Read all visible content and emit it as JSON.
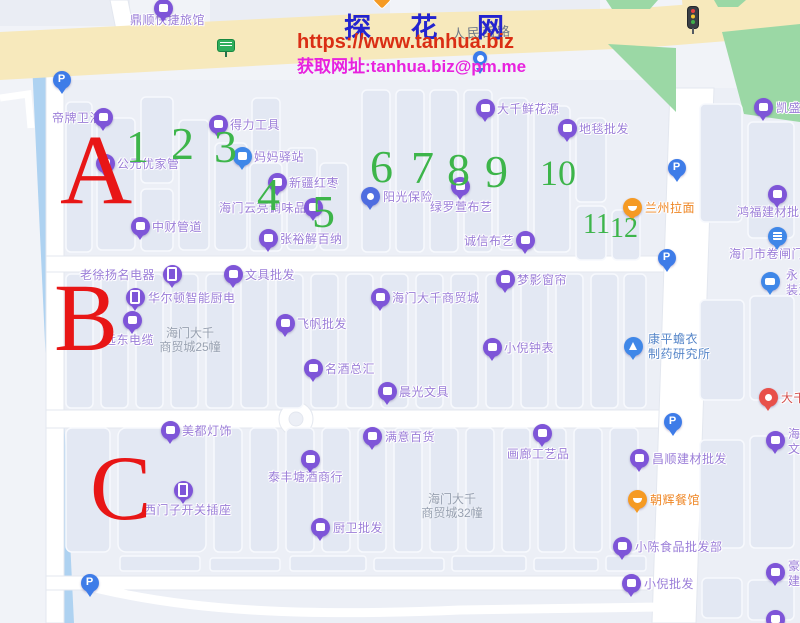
{
  "watermark": {
    "title": "探 花 网",
    "url": "https://www.tanhua.biz",
    "contact": "获取网址:tanhua.biz@pm.me"
  },
  "map": {
    "road_label": "人民西路",
    "markers": {
      "letters": [
        {
          "t": "A",
          "x": 60,
          "y": 120,
          "s": 100
        },
        {
          "t": "B",
          "x": 54,
          "y": 270,
          "s": 96
        },
        {
          "t": "C",
          "x": 90,
          "y": 442,
          "s": 92
        }
      ],
      "numbers": [
        {
          "t": "1",
          "x": 126,
          "y": 124,
          "s": 46
        },
        {
          "t": "2",
          "x": 171,
          "y": 121,
          "s": 46
        },
        {
          "t": "3",
          "x": 214,
          "y": 124,
          "s": 46
        },
        {
          "t": "4",
          "x": 257,
          "y": 172,
          "s": 46
        },
        {
          "t": "5",
          "x": 312,
          "y": 189,
          "s": 46
        },
        {
          "t": "6",
          "x": 370,
          "y": 144,
          "s": 46
        },
        {
          "t": "7",
          "x": 411,
          "y": 145,
          "s": 46
        },
        {
          "t": "8",
          "x": 447,
          "y": 147,
          "s": 46
        },
        {
          "t": "9",
          "x": 485,
          "y": 149,
          "s": 46
        },
        {
          "t": "10",
          "x": 540,
          "y": 155,
          "s": 36
        },
        {
          "t": "11",
          "x": 583,
          "y": 211,
          "s": 28
        },
        {
          "t": "12",
          "x": 610,
          "y": 215,
          "s": 28
        }
      ]
    },
    "pois": [
      {
        "name": "鼎顺快捷旅馆",
        "icon": "shop",
        "x": 163,
        "y": 8,
        "label": {
          "lines": [
            "鼎顺快捷旅馆"
          ],
          "lx": 130,
          "ly": 13
        }
      },
      {
        "name": "顶部橙色兴趣点",
        "icon": "diamond",
        "x": 385,
        "y": 3
      },
      {
        "name": "公交站牌",
        "icon": "busstop",
        "x": 227,
        "y": 49
      },
      {
        "name": "红绿灯",
        "icon": "light",
        "x": 697,
        "y": 16
      },
      {
        "name": "蓝色图钉",
        "icon": "bluepin",
        "x": 480,
        "y": 58
      },
      {
        "name": "凯盛",
        "icon": "shop",
        "x": 763,
        "y": 107,
        "label": {
          "lines": [
            "凯盛"
          ],
          "lx": 776,
          "ly": 101
        }
      },
      {
        "name": "帝牌卫浴",
        "icon": "shop",
        "x": 103,
        "y": 117,
        "label": {
          "lines": [
            "帝牌卫浴"
          ],
          "lx": 52,
          "ly": 111
        }
      },
      {
        "name": "得力工具",
        "icon": "shop",
        "x": 218,
        "y": 124,
        "label": {
          "lines": [
            "得力工具"
          ],
          "lx": 230,
          "ly": 118
        }
      },
      {
        "name": "妈妈驿站",
        "icon": "blueshop",
        "x": 242,
        "y": 156,
        "label": {
          "lines": [
            "妈妈驿站"
          ],
          "lx": 254,
          "ly": 150
        }
      },
      {
        "name": "公元优家管",
        "icon": "shop",
        "x": 105,
        "y": 163,
        "label": {
          "lines": [
            "公元优家管"
          ],
          "lx": 117,
          "ly": 157
        }
      },
      {
        "name": "新疆红枣",
        "icon": "shop",
        "x": 277,
        "y": 182,
        "label": {
          "lines": [
            "新疆红枣"
          ],
          "lx": 289,
          "ly": 176
        }
      },
      {
        "name": "海门云亮调味品",
        "icon": "shop",
        "x": 313,
        "y": 207,
        "label": {
          "lines": [
            "海门云亮调味品"
          ],
          "lx": 219,
          "ly": 201
        }
      },
      {
        "name": "中财管道",
        "icon": "shop",
        "x": 140,
        "y": 226,
        "label": {
          "lines": [
            "中财管道"
          ],
          "lx": 152,
          "ly": 220
        }
      },
      {
        "name": "张裕解百纳",
        "icon": "shop",
        "x": 268,
        "y": 238,
        "label": {
          "lines": [
            "张裕解百纳"
          ],
          "lx": 280,
          "ly": 232
        }
      },
      {
        "name": "阳光保险",
        "icon": "sun",
        "x": 370,
        "y": 196,
        "label": {
          "lines": [
            "阳光保险"
          ],
          "lx": 383,
          "ly": 190
        }
      },
      {
        "name": "绿罗萱布艺",
        "icon": "shop",
        "x": 460,
        "y": 186,
        "label": {
          "lines": [
            "绿罗萱布艺"
          ],
          "lx": 430,
          "ly": 200
        }
      },
      {
        "name": "大千鲜花源",
        "icon": "shop",
        "x": 485,
        "y": 108,
        "label": {
          "lines": [
            "大千鲜花源"
          ],
          "lx": 497,
          "ly": 102
        }
      },
      {
        "name": "地毯批发",
        "icon": "shop",
        "x": 567,
        "y": 128,
        "label": {
          "lines": [
            "地毯批发"
          ],
          "lx": 579,
          "ly": 122
        }
      },
      {
        "name": "诚信布艺",
        "icon": "shop",
        "x": 525,
        "y": 240,
        "label": {
          "lines": [
            "诚信布艺"
          ],
          "lx": 464,
          "ly": 234
        }
      },
      {
        "name": "兰州拉面",
        "icon": "food",
        "x": 632,
        "y": 207,
        "label": {
          "lines": [
            "兰州拉面"
          ],
          "lx": 645,
          "ly": 201,
          "cls": "orange"
        }
      },
      {
        "name": "鸿福建材批发",
        "icon": "shop",
        "x": 777,
        "y": 194,
        "label": {
          "lines": [
            "鸿福建材批发"
          ],
          "lx": 737,
          "ly": 205
        }
      },
      {
        "name": "海门市卷闸门",
        "icon": "door",
        "x": 777,
        "y": 236,
        "label": {
          "lines": [
            "海门市卷闸门"
          ],
          "lx": 729,
          "ly": 247
        }
      },
      {
        "name": "永昌装潢",
        "icon": "bus",
        "x": 770,
        "y": 281,
        "label": {
          "lines": [
            "永昌",
            "装潢"
          ],
          "lx": 786,
          "ly": 268
        }
      },
      {
        "name": "老徐扬名电器",
        "icon": "phone",
        "x": 172,
        "y": 274,
        "label": {
          "lines": [
            "老徐扬名电器"
          ],
          "lx": 80,
          "ly": 268
        }
      },
      {
        "name": "文具批发",
        "icon": "shop",
        "x": 233,
        "y": 274,
        "label": {
          "lines": [
            "文具批发"
          ],
          "lx": 245,
          "ly": 268
        }
      },
      {
        "name": "华尔顿智能厨电",
        "icon": "phone",
        "x": 135,
        "y": 297,
        "label": {
          "lines": [
            "华尔顿智能厨电"
          ],
          "lx": 148,
          "ly": 291
        }
      },
      {
        "name": "远东电缆",
        "icon": "shop",
        "x": 132,
        "y": 320,
        "label": {
          "lines": [
            "远东电缆"
          ],
          "lx": 104,
          "ly": 333
        }
      },
      {
        "name": "海门大千商贸城",
        "icon": "shop",
        "x": 380,
        "y": 297,
        "label": {
          "lines": [
            "海门大千商贸城"
          ],
          "lx": 392,
          "ly": 291
        }
      },
      {
        "name": "梦影窗帘",
        "icon": "shop",
        "x": 505,
        "y": 279,
        "label": {
          "lines": [
            "梦影窗帘"
          ],
          "lx": 517,
          "ly": 273
        }
      },
      {
        "name": "飞帆批发",
        "icon": "shop",
        "x": 285,
        "y": 323,
        "label": {
          "lines": [
            "飞帆批发"
          ],
          "lx": 297,
          "ly": 317
        }
      },
      {
        "name": "小倪钟表",
        "icon": "shop",
        "x": 492,
        "y": 347,
        "label": {
          "lines": [
            "小倪钟表"
          ],
          "lx": 504,
          "ly": 341
        }
      },
      {
        "name": "名酒总汇",
        "icon": "shop",
        "x": 313,
        "y": 368,
        "label": {
          "lines": [
            "名酒总汇"
          ],
          "lx": 325,
          "ly": 362
        }
      },
      {
        "name": "晨光文具",
        "icon": "shop",
        "x": 387,
        "y": 391,
        "label": {
          "lines": [
            "晨光文具"
          ],
          "lx": 399,
          "ly": 385
        }
      },
      {
        "name": "康平蟾衣制药研究所",
        "icon": "flask",
        "x": 633,
        "y": 346,
        "label": {
          "lines": [
            "康平蟾衣",
            "制药研究所"
          ],
          "lx": 648,
          "ly": 332,
          "cls": "blue"
        }
      },
      {
        "name": "大千",
        "icon": "red",
        "x": 768,
        "y": 397,
        "label": {
          "lines": [
            "大千"
          ],
          "lx": 781,
          "ly": 391,
          "cls": "red"
        }
      },
      {
        "name": "海门文",
        "icon": "shop",
        "x": 775,
        "y": 440,
        "label": {
          "lines": [
            "海",
            "文"
          ],
          "lx": 788,
          "ly": 427
        }
      },
      {
        "name": "美都灯饰",
        "icon": "shop",
        "x": 170,
        "y": 430,
        "label": {
          "lines": [
            "美都灯饰"
          ],
          "lx": 182,
          "ly": 424
        }
      },
      {
        "name": "西门子开关插座",
        "icon": "phone",
        "x": 183,
        "y": 490,
        "label": {
          "lines": [
            "西门子开关插座"
          ],
          "lx": 144,
          "ly": 503
        }
      },
      {
        "name": "泰丰塘酒商行",
        "icon": "shop",
        "x": 310,
        "y": 459,
        "label": {
          "lines": [
            "泰丰塘酒商行"
          ],
          "lx": 268,
          "ly": 470
        }
      },
      {
        "name": "满意百货",
        "icon": "shop",
        "x": 372,
        "y": 436,
        "label": {
          "lines": [
            "满意百货"
          ],
          "lx": 385,
          "ly": 430
        }
      },
      {
        "name": "厨卫批发",
        "icon": "shop",
        "x": 320,
        "y": 527,
        "label": {
          "lines": [
            "厨卫批发"
          ],
          "lx": 333,
          "ly": 521
        }
      },
      {
        "name": "画廊工艺品",
        "icon": "shop",
        "x": 542,
        "y": 433,
        "label": {
          "lines": [
            "画廊工艺品"
          ],
          "lx": 507,
          "ly": 447
        }
      },
      {
        "name": "昌顺建材批发",
        "icon": "shop",
        "x": 639,
        "y": 458,
        "label": {
          "lines": [
            "昌顺建材批发"
          ],
          "lx": 652,
          "ly": 452
        }
      },
      {
        "name": "朝辉餐馆",
        "icon": "food",
        "x": 637,
        "y": 499,
        "label": {
          "lines": [
            "朝辉餐馆"
          ],
          "lx": 650,
          "ly": 493,
          "cls": "orange"
        }
      },
      {
        "name": "小陈食品批发部",
        "icon": "shop",
        "x": 622,
        "y": 546,
        "label": {
          "lines": [
            "小陈食品批发部"
          ],
          "lx": 635,
          "ly": 540
        }
      },
      {
        "name": "小倪批发",
        "icon": "shop",
        "x": 631,
        "y": 583,
        "label": {
          "lines": [
            "小倪批发"
          ],
          "lx": 644,
          "ly": 577
        }
      },
      {
        "name": "豪建",
        "icon": "shop",
        "x": 775,
        "y": 572,
        "label": {
          "lines": [
            "豪",
            "建"
          ],
          "lx": 788,
          "ly": 559
        }
      },
      {
        "name": "底部边缘兴趣点",
        "icon": "shop",
        "x": 775,
        "y": 619
      },
      {
        "name": "停车场",
        "icon": "parking",
        "x": 62,
        "y": 80
      },
      {
        "name": "停车场",
        "icon": "parking",
        "x": 677,
        "y": 168
      },
      {
        "name": "停车场",
        "icon": "parking",
        "x": 667,
        "y": 258
      },
      {
        "name": "停车场",
        "icon": "parking",
        "x": 673,
        "y": 422
      },
      {
        "name": "停车场",
        "icon": "parking",
        "x": 90,
        "y": 583
      }
    ],
    "building_labels": [
      {
        "lines": [
          "海门大千",
          "商贸城25幢"
        ],
        "x": 154,
        "y": 326
      },
      {
        "lines": [
          "海门大千",
          "商贸城32幢"
        ],
        "x": 416,
        "y": 492
      }
    ]
  },
  "colors": {
    "poi_purple": "#7e55d8",
    "poi_blue": "#3f87e8",
    "poi_orange": "#f59a23",
    "zone_letter_red": "#e81616",
    "stall_number_green": "#3db54a",
    "road_yellow": "#f7e9bc",
    "greenery": "#9bd8a5",
    "river_blue": "#aed2f1"
  }
}
